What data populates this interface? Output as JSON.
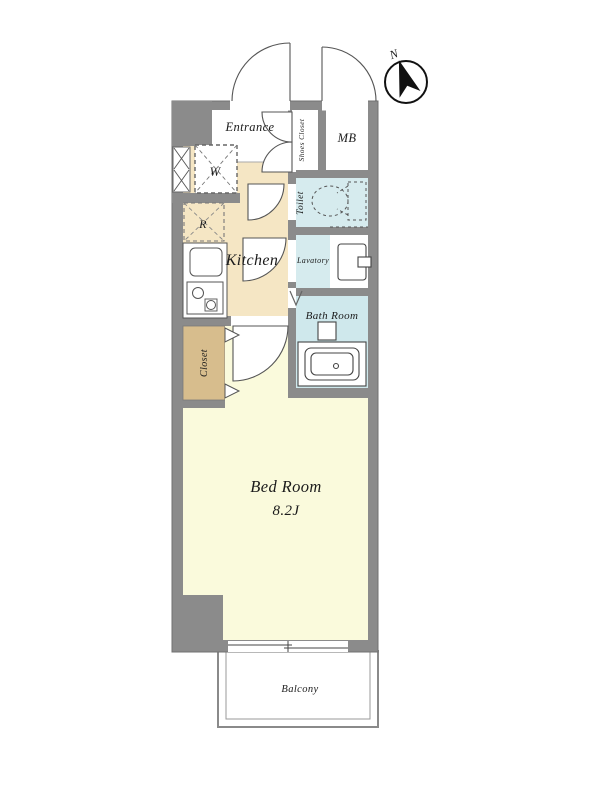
{
  "plan": {
    "rooms": {
      "entrance": {
        "label": "Entrance"
      },
      "shoes_closet": {
        "label": "Shoes Closet"
      },
      "mb": {
        "label": "MB"
      },
      "toilet": {
        "label": "Toilet"
      },
      "kitchen": {
        "label": "Kitchen"
      },
      "lavatory": {
        "label": "Lavatory"
      },
      "bath": {
        "label": "Bath Room"
      },
      "closet": {
        "label": "Closet"
      },
      "bedroom": {
        "label": "Bed Room",
        "size": "8.2J"
      },
      "balcony": {
        "label": "Balcony"
      }
    },
    "fixtures": {
      "washer": "W",
      "refrigerator": "R"
    },
    "compass": {
      "north": "N"
    },
    "colors": {
      "wall": "#8b8b8b",
      "kitchen": "#f5e6c4",
      "bedroom": "#fafadc",
      "wet": "#d6ebee",
      "bath": "#cfe8ec",
      "closet": "#d7bd8d"
    }
  }
}
